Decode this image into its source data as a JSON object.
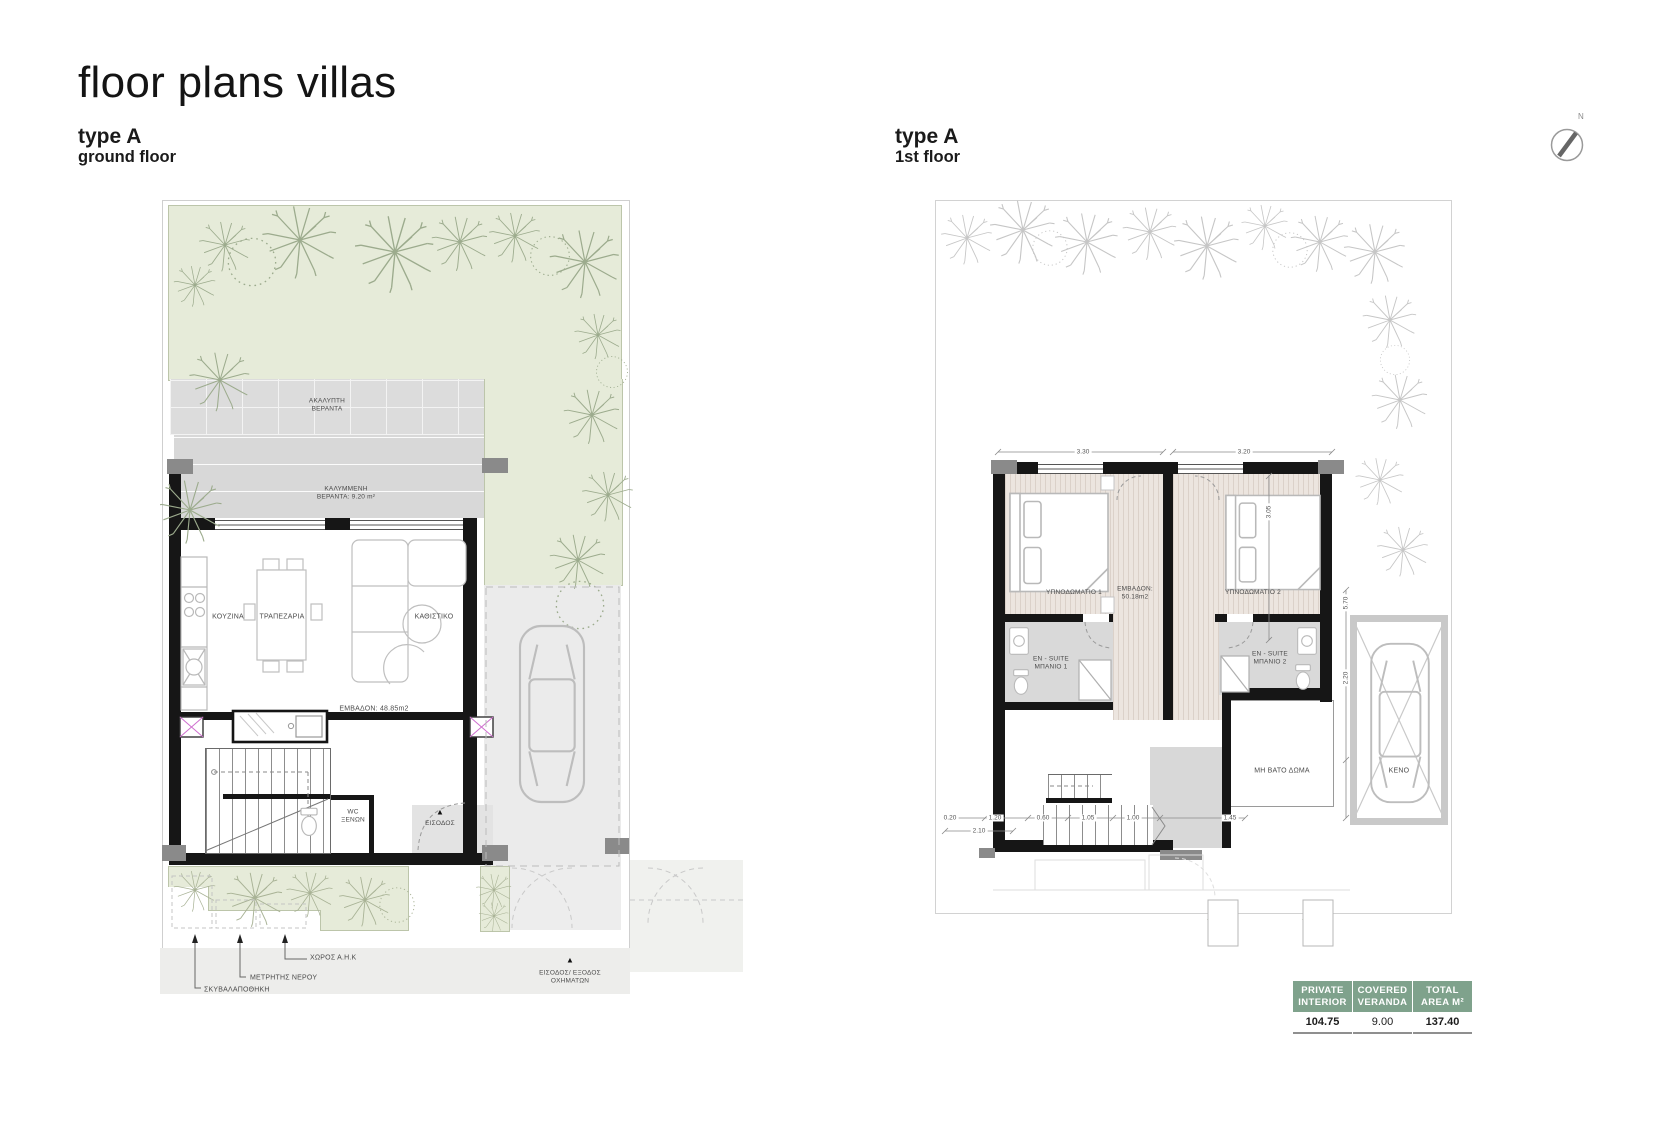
{
  "title": "floor plans villas",
  "compass": {
    "label": "N"
  },
  "plans": {
    "left": {
      "heading": "type A",
      "subheading": "ground floor",
      "veranda_uncovered": "ΑΚΑΛΥΠΤΗ\nΒΕΡΑΝΤΑ",
      "veranda_covered": "ΚΑΛΥΜΜΕΝΗ\nΒΕΡΑΝΤΑ: 9.20 m²",
      "kitchen": "ΚΟΥΖΙΝΑ",
      "dining": "ΤΡΑΠΕΖΑΡΙΑ",
      "living": "ΚΑΘΙΣΤΙΚΟ",
      "area": "ΕΜΒΑΔΟΝ: 48.85m2",
      "wc": "WC\nΞΕΝΩΝ",
      "entrance": "ΕΙΣΟΔΟΣ",
      "entrance_arrow": "▲",
      "garbage": "ΣΚΥΒΑΛΑΠΟΘΗΚΗ",
      "water_meter": "ΜΕΤΡΗΤΗΣ ΝΕΡΟΥ",
      "ahk": "ΧΩΡΟΣ Α.Η.Κ",
      "vehicle_access": "ΕΙΣΟΔΟΣ/ ΕΞΟΔΟΣ\nΟΧΗΜΑΤΩΝ",
      "vehicle_arrow": "▲"
    },
    "right": {
      "heading": "type A",
      "subheading": "1st floor",
      "bedroom1": "ΥΠΝΟΔΩΜΑΤΙΟ 1",
      "bedroom2": "ΥΠΝΟΔΩΜΑΤΙΟ 2",
      "area": "ΕΜΒΑΔΟΝ:\n50.18m2",
      "ensuite1": "EN - SUITE\nΜΠΑΝΙΟ 1",
      "ensuite2": "EN - SUITE\nΜΠΑΝΙΟ 2",
      "roof": "ΜΗ ΒΑΤΟ ΔΩΜΑ",
      "void": "ΚΕΝΟ",
      "dims": {
        "top1": "3.30",
        "top2": "3.20",
        "side1": "3.05",
        "side2": "5.70",
        "side3": "2.20",
        "b1": "0.20",
        "b2": "1.20",
        "b3": "0.60",
        "b4": "1.05",
        "b5": "1.00",
        "b6": "1.45",
        "b7": "2.10"
      }
    }
  },
  "table": {
    "headers": [
      "PRIVATE\nINTERIOR",
      "COVERED\nVERANDA",
      "TOTAL\nAREA M²"
    ],
    "values": [
      "104.75",
      "9.00",
      "137.40"
    ]
  },
  "colors": {
    "accent_green": "#7fa28c",
    "garden_green": "#e6ebd9",
    "wall_black": "#161616"
  }
}
